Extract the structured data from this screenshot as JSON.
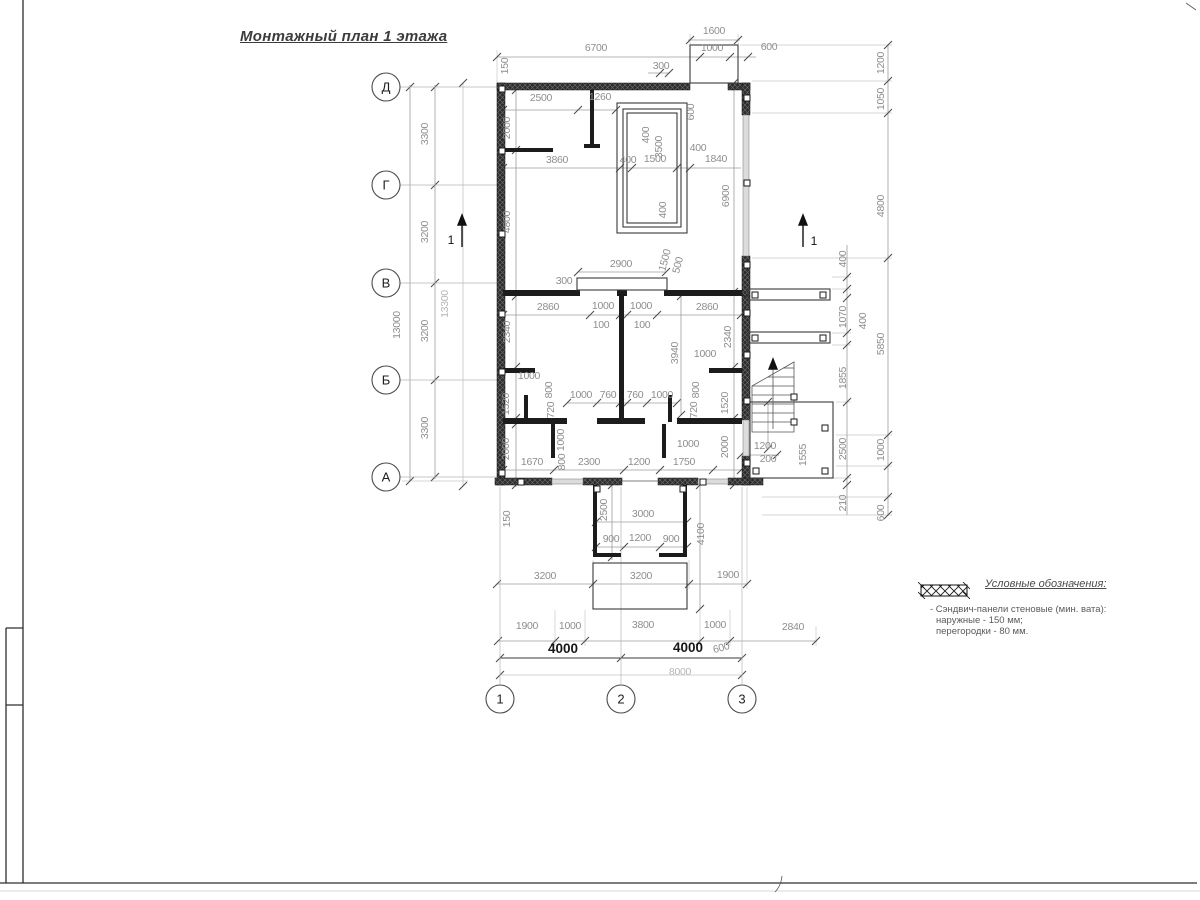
{
  "title": "Монтажный план 1 этажа",
  "legend": {
    "title": "Условные обозначения:",
    "items": [
      {
        "symbol": "sandwich-panel-hatch",
        "lines": [
          "- Сэндвич-панели стеновые (мин. вата):",
          "наружные - 150 мм;",
          "перегородки - 80 мм."
        ]
      }
    ]
  },
  "axes": {
    "rows": [
      {
        "label": "Д",
        "x": 386,
        "y": 87
      },
      {
        "label": "Г",
        "x": 386,
        "y": 185
      },
      {
        "label": "В",
        "x": 386,
        "y": 283
      },
      {
        "label": "Б",
        "x": 386,
        "y": 380
      },
      {
        "label": "А",
        "x": 386,
        "y": 477
      }
    ],
    "cols": [
      {
        "label": "1",
        "x": 500,
        "y": 699
      },
      {
        "label": "2",
        "x": 621,
        "y": 699
      },
      {
        "label": "3",
        "x": 742,
        "y": 699
      }
    ]
  },
  "section_marks": [
    {
      "label": "1",
      "lx": 451,
      "ly": 244,
      "ax": 462,
      "ay1": 247,
      "ay2": 221
    },
    {
      "label": "1",
      "lx": 814,
      "ly": 245,
      "ax": 803,
      "ay1": 247,
      "ay2": 221
    }
  ],
  "dimensions": [
    {
      "t": "1600",
      "x": 714,
      "y": 34
    },
    {
      "t": "6700",
      "x": 596,
      "y": 51
    },
    {
      "t": "1000",
      "x": 712,
      "y": 51
    },
    {
      "t": "600",
      "x": 769,
      "y": 50
    },
    {
      "t": "300",
      "x": 661,
      "y": 69
    },
    {
      "t": "150",
      "x": 508,
      "y": 66,
      "r": -90
    },
    {
      "t": "2500",
      "x": 541,
      "y": 101
    },
    {
      "t": "1260",
      "x": 600,
      "y": 100
    },
    {
      "t": "2000",
      "x": 510,
      "y": 128,
      "r": -90
    },
    {
      "t": "600",
      "x": 694,
      "y": 112,
      "r": -90
    },
    {
      "t": "400",
      "x": 649,
      "y": 135,
      "r": -90
    },
    {
      "t": "3500",
      "x": 662,
      "y": 147,
      "r": -90
    },
    {
      "t": "3860",
      "x": 557,
      "y": 163
    },
    {
      "t": "400",
      "x": 628,
      "y": 163
    },
    {
      "t": "1500",
      "x": 655,
      "y": 162
    },
    {
      "t": "400",
      "x": 698,
      "y": 151
    },
    {
      "t": "1840",
      "x": 716,
      "y": 162
    },
    {
      "t": "400",
      "x": 666,
      "y": 210,
      "r": -90
    },
    {
      "t": "4800",
      "x": 510,
      "y": 222,
      "r": -90
    },
    {
      "t": "6900",
      "x": 729,
      "y": 196,
      "r": -90
    },
    {
      "t": "1200",
      "x": 884,
      "y": 63,
      "r": -90
    },
    {
      "t": "1050",
      "x": 884,
      "y": 99,
      "r": -90
    },
    {
      "t": "4800",
      "x": 884,
      "y": 206,
      "r": -90
    },
    {
      "t": "400",
      "x": 846,
      "y": 259,
      "r": -90
    },
    {
      "t": "2900",
      "x": 621,
      "y": 267
    },
    {
      "t": "300",
      "x": 564,
      "y": 284
    },
    {
      "t": "1500",
      "x": 668,
      "y": 261,
      "r": -75
    },
    {
      "t": "500",
      "x": 681,
      "y": 266,
      "r": -75
    },
    {
      "t": "2860",
      "x": 548,
      "y": 310
    },
    {
      "t": "1000",
      "x": 603,
      "y": 309
    },
    {
      "t": "1000",
      "x": 641,
      "y": 309
    },
    {
      "t": "2860",
      "x": 707,
      "y": 310
    },
    {
      "t": "100",
      "x": 601,
      "y": 328
    },
    {
      "t": "100",
      "x": 642,
      "y": 328
    },
    {
      "t": "2340",
      "x": 510,
      "y": 332,
      "r": -90
    },
    {
      "t": "2340",
      "x": 731,
      "y": 337,
      "r": -90
    },
    {
      "t": "3940",
      "x": 678,
      "y": 353,
      "r": -90
    },
    {
      "t": "1000",
      "x": 705,
      "y": 357
    },
    {
      "t": "1070",
      "x": 846,
      "y": 317,
      "r": -90
    },
    {
      "t": "400",
      "x": 866,
      "y": 321,
      "r": -90
    },
    {
      "t": "5850",
      "x": 884,
      "y": 344,
      "r": -90
    },
    {
      "t": "1855",
      "x": 846,
      "y": 378,
      "r": -90
    },
    {
      "t": "1000",
      "x": 529,
      "y": 379
    },
    {
      "t": "1520",
      "x": 509,
      "y": 404,
      "r": -90
    },
    {
      "t": "800",
      "x": 552,
      "y": 390,
      "r": -90
    },
    {
      "t": "720",
      "x": 554,
      "y": 410,
      "r": -90
    },
    {
      "t": "1000",
      "x": 581,
      "y": 398
    },
    {
      "t": "760",
      "x": 608,
      "y": 398
    },
    {
      "t": "760",
      "x": 635,
      "y": 398
    },
    {
      "t": "1000",
      "x": 662,
      "y": 398
    },
    {
      "t": "800",
      "x": 699,
      "y": 390,
      "r": -90
    },
    {
      "t": "720",
      "x": 697,
      "y": 410,
      "r": -90
    },
    {
      "t": "1520",
      "x": 728,
      "y": 403,
      "r": -90
    },
    {
      "t": "2000",
      "x": 509,
      "y": 449,
      "r": -90
    },
    {
      "t": "1000",
      "x": 564,
      "y": 440,
      "r": -90
    },
    {
      "t": "800",
      "x": 565,
      "y": 462,
      "r": -90
    },
    {
      "t": "1000",
      "x": 688,
      "y": 447
    },
    {
      "t": "2000",
      "x": 728,
      "y": 447,
      "r": -90
    },
    {
      "t": "1670",
      "x": 532,
      "y": 465
    },
    {
      "t": "2300",
      "x": 589,
      "y": 465
    },
    {
      "t": "1200",
      "x": 639,
      "y": 465
    },
    {
      "t": "1750",
      "x": 684,
      "y": 465
    },
    {
      "t": "1200",
      "x": 765,
      "y": 449
    },
    {
      "t": "200",
      "x": 768,
      "y": 462
    },
    {
      "t": "1555",
      "x": 806,
      "y": 455,
      "r": -90
    },
    {
      "t": "2500",
      "x": 846,
      "y": 449,
      "r": -90
    },
    {
      "t": "1000",
      "x": 884,
      "y": 450,
      "r": -90
    },
    {
      "t": "210",
      "x": 846,
      "y": 503,
      "r": -90
    },
    {
      "t": "600",
      "x": 884,
      "y": 513,
      "r": -90
    },
    {
      "t": "150",
      "x": 510,
      "y": 519,
      "r": -90
    },
    {
      "t": "2500",
      "x": 607,
      "y": 510,
      "r": -90
    },
    {
      "t": "3000",
      "x": 643,
      "y": 517
    },
    {
      "t": "900",
      "x": 611,
      "y": 542
    },
    {
      "t": "1200",
      "x": 640,
      "y": 541
    },
    {
      "t": "900",
      "x": 671,
      "y": 542
    },
    {
      "t": "4100",
      "x": 704,
      "y": 534,
      "r": -90
    },
    {
      "t": "3200",
      "x": 545,
      "y": 579
    },
    {
      "t": "3200",
      "x": 641,
      "y": 579
    },
    {
      "t": "1900",
      "x": 728,
      "y": 578
    },
    {
      "t": "1900",
      "x": 527,
      "y": 629
    },
    {
      "t": "1000",
      "x": 570,
      "y": 629
    },
    {
      "t": "3800",
      "x": 643,
      "y": 628
    },
    {
      "t": "1000",
      "x": 715,
      "y": 628
    },
    {
      "t": "2840",
      "x": 793,
      "y": 630
    },
    {
      "t": "600",
      "x": 722,
      "y": 651,
      "r": -15
    },
    {
      "t": "4000",
      "x": 563,
      "y": 653,
      "c": "dark"
    },
    {
      "t": "4000",
      "x": 688,
      "y": 652,
      "c": "dark"
    },
    {
      "t": "8000",
      "x": 680,
      "y": 675,
      "c": "light"
    },
    {
      "t": "3300",
      "x": 428,
      "y": 134,
      "r": -90
    },
    {
      "t": "3200",
      "x": 428,
      "y": 232,
      "r": -90
    },
    {
      "t": "13000",
      "x": 400,
      "y": 325,
      "r": -90
    },
    {
      "t": "3200",
      "x": 428,
      "y": 331,
      "r": -90
    },
    {
      "t": "3300",
      "x": 428,
      "y": 428,
      "r": -90
    },
    {
      "t": "13300",
      "x": 448,
      "y": 304,
      "r": -90,
      "c": "light"
    }
  ]
}
